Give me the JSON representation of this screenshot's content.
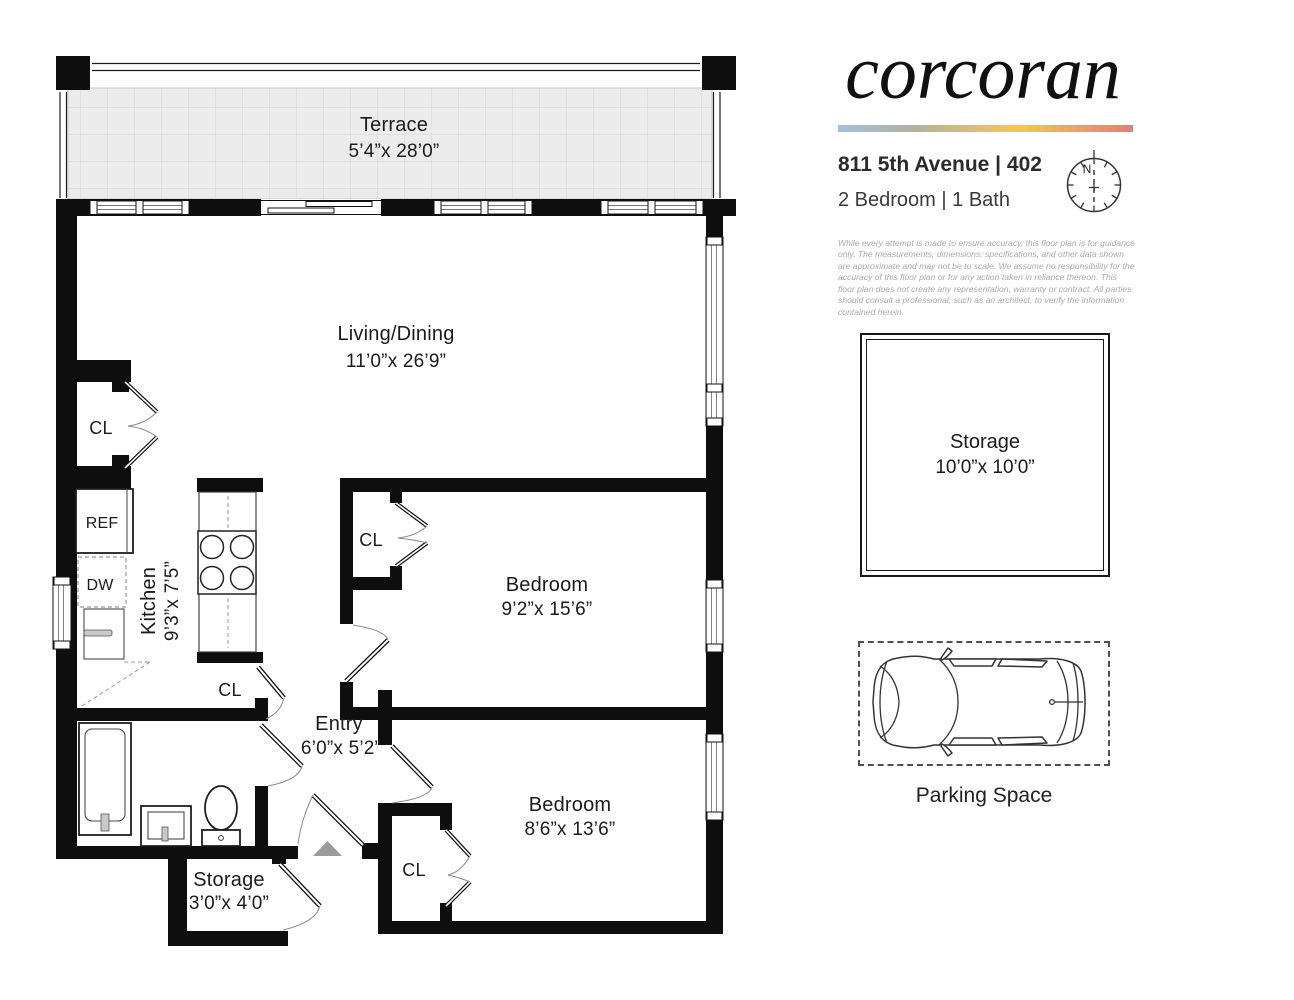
{
  "brand": {
    "logo_text": "corcoran",
    "accent_gradient": [
      "#a6c0da",
      "#b3b1a4",
      "#f2c94c",
      "#f0a15f",
      "#ec7a7d"
    ]
  },
  "listing": {
    "address_line": "811 5th Avenue | 402",
    "info_line": "2 Bedroom | 1 Bath"
  },
  "compass": {
    "north_label": "N"
  },
  "disclaimer": "While every attempt is made to ensure accuracy, this floor plan is for guidance only. The measurements, dimensions, specifications, and other data shown are approximate and may not be to scale. We assume no responsibility for the accuracy of this floor plan or for any action taken in reliance thereon. This floor plan does not create any representation, warranty or contract. All parties should consult a professional, such as an architect, to verify the information contained herein.",
  "floorplan": {
    "terrace": {
      "label": "Terrace",
      "dims": "5’4”x 28’0”"
    },
    "living_dining": {
      "label": "Living/Dining",
      "dims": "11’0”x 26’9”"
    },
    "kitchen": {
      "label": "Kitchen",
      "dims": "9’3”x 7’5”"
    },
    "bedroom_1": {
      "label": "Bedroom",
      "dims": "9’2”x 15’6”"
    },
    "bedroom_2": {
      "label": "Bedroom",
      "dims": "8’6”x 13’6”"
    },
    "entry": {
      "label": "Entry",
      "dims": "6’0”x 5’2”"
    },
    "storage_closet": {
      "label": "Storage",
      "dims": "3’0”x 4’0”"
    },
    "closet_label": "CL",
    "refrigerator_label": "REF",
    "dishwasher_label": "DW"
  },
  "storage_room": {
    "label": "Storage",
    "dims": "10’0”x 10’0”"
  },
  "parking": {
    "label": "Parking Space"
  },
  "colors": {
    "wall": "#0e0e0e",
    "terrace_fill": "#ececec",
    "entry_arrow": "#9b9b9b"
  }
}
